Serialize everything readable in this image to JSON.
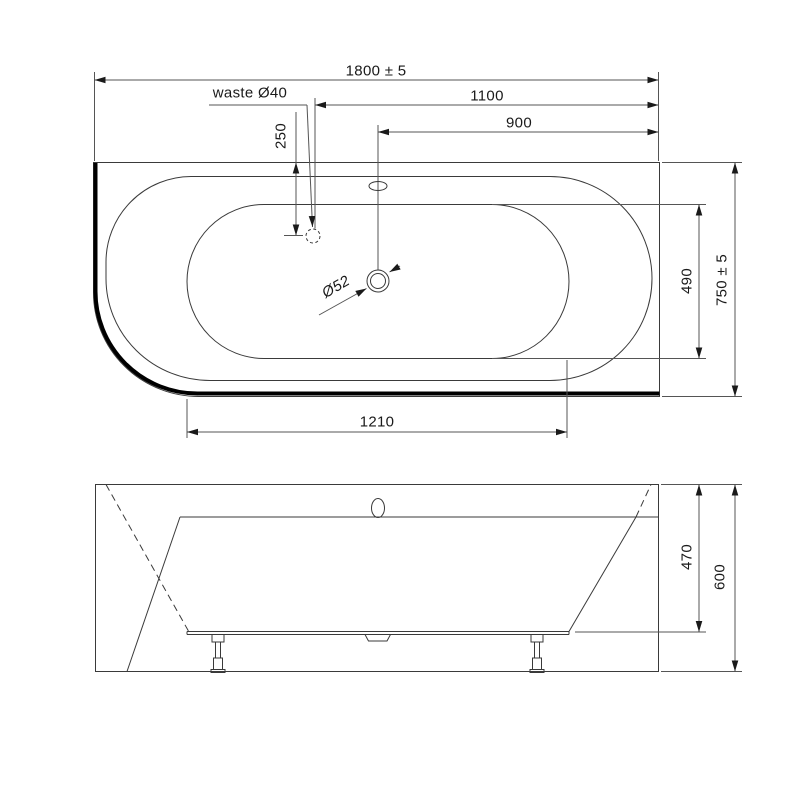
{
  "view_top": {
    "dim_overall_width": "1800 ± 5",
    "dim_waste_from_right": "1100",
    "dim_drain_from_right": "900",
    "dim_waste_from_back": "250",
    "label_waste": "waste Ø40",
    "label_drain": "Ø52",
    "dim_basin_inner_width": "490",
    "dim_overall_depth": "750 ± 5",
    "dim_basin_inner_length": "1210"
  },
  "view_front": {
    "dim_inner_depth": "470",
    "dim_overall_height": "600"
  },
  "style": {
    "tub_fill": "#e6e7e8",
    "foot_fill": "#f2f2f2",
    "hole_fill": "#ffffff",
    "line_color": "#3a3a3a",
    "thick_line_color": "#000000"
  }
}
